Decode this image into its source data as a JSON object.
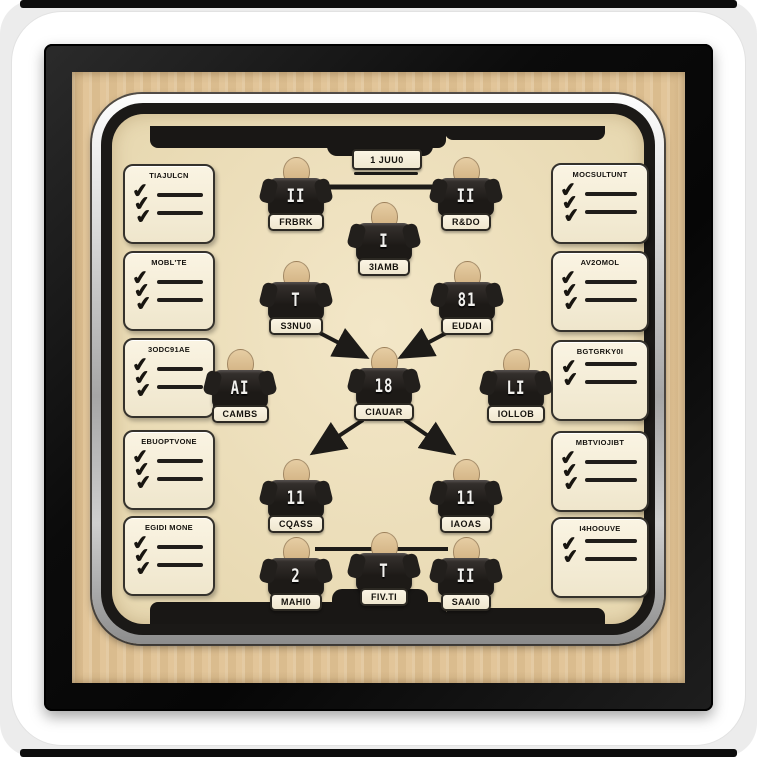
{
  "title": "Framed football tactics board sticker",
  "top_label": "1 JUU0",
  "icons": {
    "check": "✔"
  },
  "colors": {
    "frame": "#161616",
    "wood_mat": "#e0c294",
    "board": "#eee0bc",
    "silver_trim": "#c9c9c9",
    "card_bg": "#f6efdc",
    "jersey": "#23201d",
    "skin": "#d9b98c",
    "ink": "#1d1b18"
  },
  "left_checklists": [
    {
      "title": "TIAJULCN"
    },
    {
      "title": "MOBL'TE"
    },
    {
      "title": "3ODC91AE"
    },
    {
      "title": "EBUOPTVONE"
    },
    {
      "title": "EGIDI MONE"
    }
  ],
  "right_checklists": [
    {
      "title": "MOCSULTUNT"
    },
    {
      "title": "AV2OMOL"
    },
    {
      "title": "BGTGRKY0I"
    },
    {
      "title": "MBTVIOJIBT"
    },
    {
      "title": "I4HOOUVE"
    }
  ],
  "players": [
    {
      "number": "II",
      "name": "FRBRK"
    },
    {
      "number": "II",
      "name": "R&DO"
    },
    {
      "number": "I",
      "name": "3IAMB"
    },
    {
      "number": "T",
      "name": "S3NU0"
    },
    {
      "number": "81",
      "name": "EUDAI"
    },
    {
      "number": "AI",
      "name": "CAMBS"
    },
    {
      "number": "18",
      "name": "CIAUAR"
    },
    {
      "number": "LI",
      "name": "IOLLOB"
    },
    {
      "number": "11",
      "name": "CQASS"
    },
    {
      "number": "11",
      "name": "IAOAS"
    },
    {
      "number": "2",
      "name": "MAHI0"
    },
    {
      "number": "T",
      "name": "FIV.TI"
    },
    {
      "number": "II",
      "name": "SAAI0"
    }
  ]
}
